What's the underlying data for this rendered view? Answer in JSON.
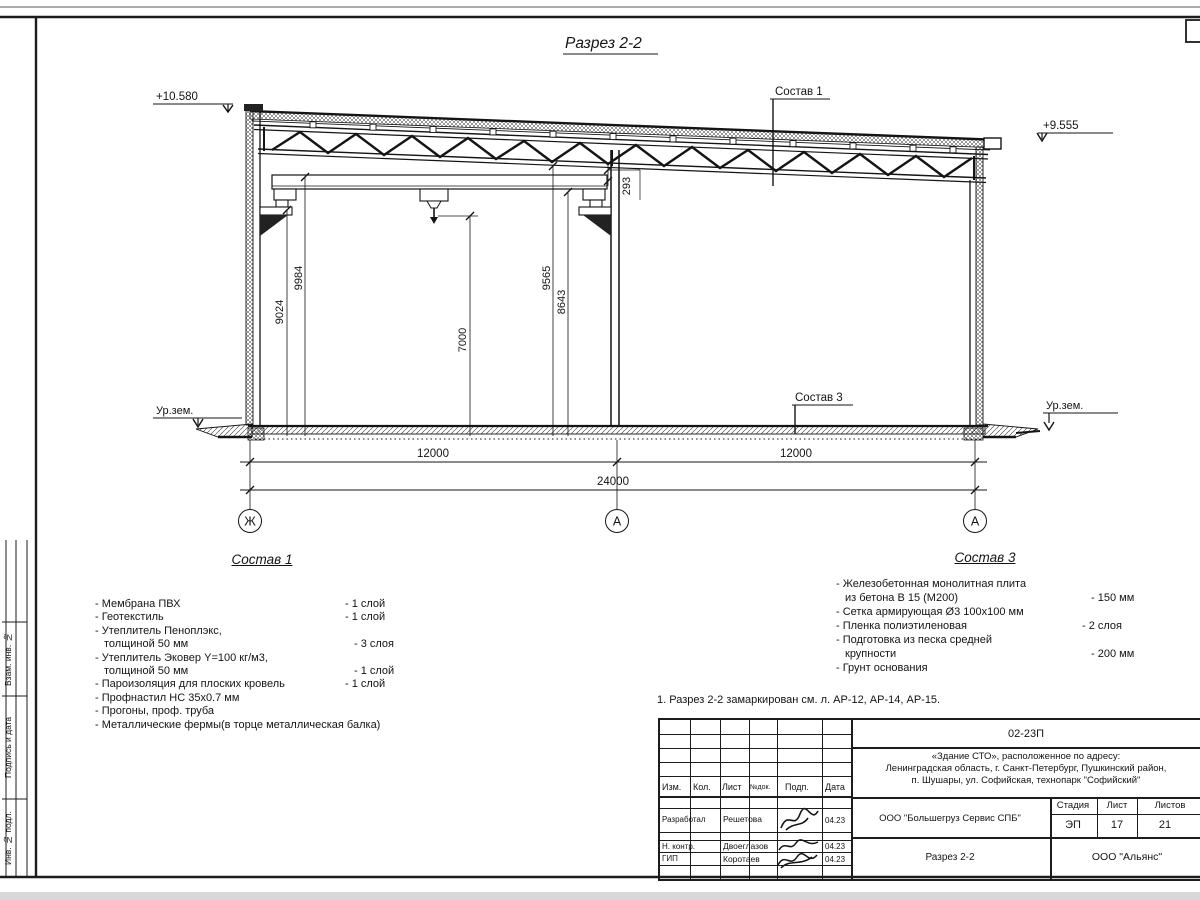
{
  "drawing": {
    "title": "Разрез 2-2",
    "elevation_left": "+10.580",
    "elevation_right": "+9.555",
    "ground_left": "Ур.зем.",
    "ground_right": "Ур.зем.",
    "leader_roof": "Состав 1",
    "leader_floor": "Состав 3",
    "dims": {
      "h_9024": "9024",
      "h_9984": "9984",
      "h_7000": "7000",
      "h_9565": "9565",
      "h_8643": "8643",
      "gap_293": "293",
      "bay_left": "12000",
      "bay_right": "12000",
      "total": "24000"
    },
    "axes": {
      "left": "Ж",
      "middle": "А",
      "right": "А"
    }
  },
  "composition1": {
    "title": "Состав 1",
    "items": [
      {
        "name": "- Мембрана ПВХ",
        "value": "- 1 слой"
      },
      {
        "name": "- Геотекстиль",
        "value": "- 1 слой"
      },
      {
        "name": "- Утеплитель Пеноплэкс,",
        "value": ""
      },
      {
        "name": "толщиной 50 мм",
        "value": "- 3 слоя"
      },
      {
        "name": "- Утеплитель Эковер Y=100 кг/м3,",
        "value": ""
      },
      {
        "name": "толщиной 50 мм",
        "value": "- 1 слой"
      },
      {
        "name": "- Пароизоляция для плоских кровель",
        "value": "- 1 слой"
      },
      {
        "name": "- Профнастил НС 35х0.7 мм",
        "value": ""
      },
      {
        "name": "- Прогоны, проф. труба",
        "value": ""
      },
      {
        "name": "- Металлические фермы(в торце металлическая балка)",
        "value": ""
      }
    ]
  },
  "composition3": {
    "title": "Состав 3",
    "items": [
      {
        "name": "- Железобетонная  монолитная плита",
        "value": ""
      },
      {
        "name": "из бетона В 15 (М200)",
        "value": "- 150 мм"
      },
      {
        "name": "- Сетка армирующая Ø3 100х100 мм",
        "value": ""
      },
      {
        "name": "- Пленка полиэтиленовая",
        "value": "-  2 слоя"
      },
      {
        "name": "- Подготовка из песка средней",
        "value": ""
      },
      {
        "name": "крупности",
        "value": "- 200 мм"
      },
      {
        "name": "- Грунт основания",
        "value": ""
      }
    ]
  },
  "note": "1. Разрез 2-2 замаркирован см. л. АР-12, АР-14, АР-15.",
  "titleblock": {
    "doc_number": "02-23П",
    "project_line1": "«Здание СТО», расположенное по адресу:",
    "project_line2": "Ленинградская область, г. Санкт-Петербург, Пушкинский район,",
    "project_line3": "п. Шушары, ул. Софийская, технопарк \"Софийский\"",
    "header_cols": [
      "Изм.",
      "Кол.",
      "Лист",
      "№док.",
      "Подп.",
      "Дата"
    ],
    "rows": [
      {
        "role": "Разработал",
        "name": "Решетова",
        "date": "04.23"
      },
      {
        "role": "Н. контр.",
        "name": "Двоеглазов",
        "date": "04.23"
      },
      {
        "role": "ГИП",
        "name": "Коротаев",
        "date": "04.23"
      }
    ],
    "client": "ООО \"Большегруз Сервис СПБ\"",
    "sheet_title": "Разрез 2-2",
    "company": "ООО \"Альянс\"",
    "stage_label": "Стадия",
    "sheet_label": "Лист",
    "sheets_label": "Листов",
    "stage": "ЭП",
    "sheet": "17",
    "sheets": "21"
  },
  "frame": {
    "side_label1": "Взам. инв. №",
    "side_label2": "Подпись и дата",
    "side_label3": "Инв. № подл."
  }
}
